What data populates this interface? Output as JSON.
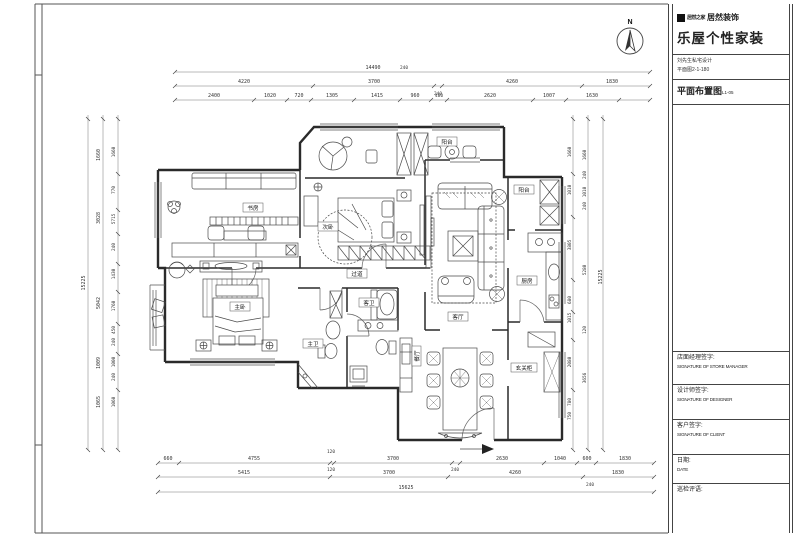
{
  "title_block": {
    "logo_small": "居然之家",
    "logo_bold": "居然装饰",
    "brand": "乐屋个性家装",
    "project_line1": "刘先生私宅设计",
    "project_line2": "平面图2-1-180",
    "drawing_title": "平面布置图",
    "drawing_no": "L1-05",
    "sign_store_cn": "店面经理签字:",
    "sign_store_en": "SIGNATURE OF STORE MANAGER",
    "sign_designer_cn": "设计师签字:",
    "sign_designer_en": "SIGNATURE OF DESIGNER",
    "sign_client_cn": "客户签字:",
    "sign_client_en": "SIGNATURE OF CLIENT",
    "date_cn": "日期:",
    "date_en": "DATE",
    "review_cn": "巡检评语:"
  },
  "compass": {
    "label": "N"
  },
  "rooms": {
    "study": "书房",
    "bedroom2": "次卧",
    "corridor": "过道",
    "master": "主卧",
    "master_bath": "主卫",
    "guest_bath": "客卫",
    "living": "客厅",
    "dining": "餐厅",
    "kitchen": "厨房",
    "balcony_south": "阳台",
    "balcony_north": "阳台",
    "entry_cabinet": "玄关柜"
  },
  "dims": {
    "top1": [
      "14490",
      "240"
    ],
    "top2": [
      "4220",
      "3700",
      "4260",
      "1830",
      "240"
    ],
    "top3": [
      "2400",
      "1020",
      "720",
      "1305",
      "1415",
      "960",
      "480",
      "2620",
      "1007",
      "1630"
    ],
    "bottom1": [
      "660",
      "4755",
      "120",
      "120",
      "3700",
      "240",
      "2630",
      "1040",
      "600",
      "1830"
    ],
    "bottom2": [
      "5415",
      "3700",
      "4260",
      "1830",
      "240"
    ],
    "bottom3": [
      "15625"
    ],
    "left_outer": "15225",
    "left_mid": [
      "1660",
      "3028",
      "5042",
      "1009",
      "1065"
    ],
    "left_inner": [
      "1660",
      "770",
      "5715",
      "240",
      "1430",
      "1760",
      "450",
      "240",
      "1000",
      "240",
      "1060"
    ],
    "right_inner": [
      "1660",
      "1010",
      "3805",
      "680",
      "1015",
      "2080",
      "780",
      "750"
    ],
    "right_mid": [
      "1660",
      "240",
      "1010",
      "240",
      "5280",
      "120",
      "3656"
    ],
    "right_outer": "15225"
  }
}
